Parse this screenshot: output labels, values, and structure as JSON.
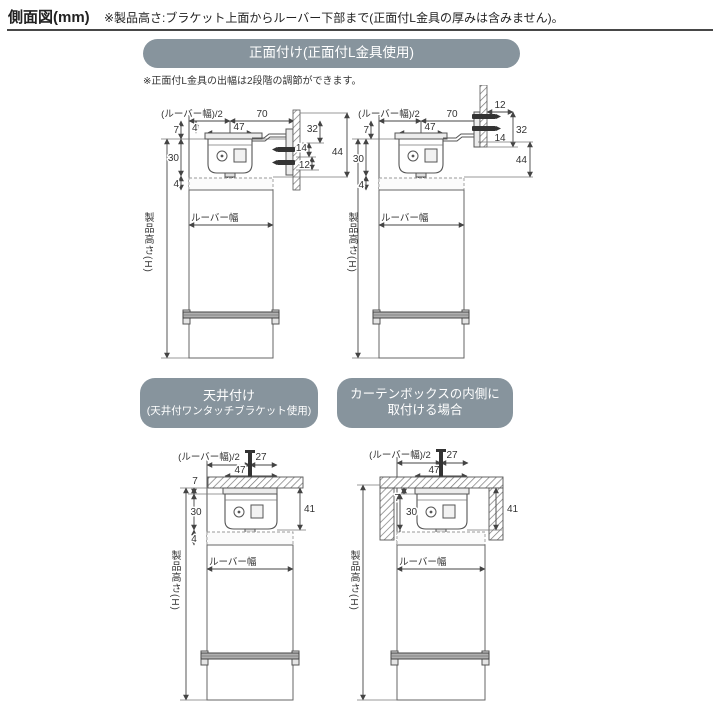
{
  "header": {
    "title": "側面図(mm)",
    "note": "※製品高さ:ブラケット上面からルーバー下部まで(正面付L金具の厚みは含みません)。"
  },
  "sections": {
    "front": {
      "banner": "正面付け(正面付L金具使用)",
      "note": "※正面付L金具の出幅は2段階の調節ができます。"
    },
    "ceiling": {
      "banner_line1": "天井付け",
      "banner_line2": "(天井付ワンタッチブラケット使用)"
    },
    "curtain_box": {
      "banner_line1": "カーテンボックスの内側に",
      "banner_line2": "取付ける場合"
    }
  },
  "labels": {
    "louver_half": "(ルーバー幅)/2",
    "louver_width": "ルーバー幅",
    "product_height": "製品高さ(H)"
  },
  "dims": {
    "d4": "4",
    "d7": "7",
    "d12": "12",
    "d14": "14",
    "d27": "27",
    "d30": "30",
    "d32": "32",
    "d41": "41",
    "d44": "44",
    "d47": "47",
    "d70": "70"
  },
  "colors": {
    "banner_bg": "#87949d",
    "drawing_line": "#555555",
    "dimension_line": "#444444",
    "text": "#333333"
  }
}
